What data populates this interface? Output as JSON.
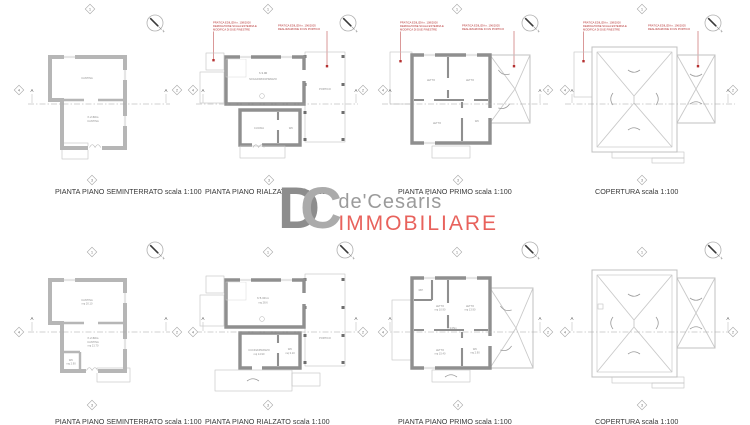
{
  "colors": {
    "annotation_red": "#b53030",
    "logo_red": "#e8625c",
    "logo_gray": "#9b9b9b",
    "wall_light": "#b6b6b6",
    "wall_dark": "#8f8f8f"
  },
  "logo": {
    "d": "D",
    "c": "C",
    "name": "de'Cesaris",
    "tag": "IMMOBILIARE"
  },
  "markers": {
    "n1": "1",
    "n2": "2",
    "n3": "3",
    "n4": "4",
    "a": "A"
  },
  "ann": {
    "a1": "PRATICA EDILIZIA n. 108/2000",
    "a2": "DEMOLIZIONE SCALA ESTERNA E",
    "a3": "MODIFICA DI DUE FINESTRE",
    "b1": "PRATICA EDILIZIA n. 196/2005",
    "b2": "REALIZZAZIONE DI UN PORTICO"
  },
  "row1": {
    "p1": {
      "title": "PIANTA PIANO SEMINTERRATO scala 1:100",
      "room_top": "CANTINA",
      "h": "h 2.60m",
      "room_bottom": "CANTINA"
    },
    "p2": {
      "title": "PIANTA PIANO RIALZATO scala 1:100",
      "h": "h 3.00",
      "living": "SOGGIORNO/PRANZO",
      "kitchen": "CUCINA",
      "wc": "WC",
      "portico": "PORTICO"
    },
    "p3": {
      "title": "PIANTA PIANO PRIMO scala 1:100",
      "r1": "LETTO",
      "r2": "LETTO",
      "r3": "LETTO",
      "wc": "WC"
    },
    "p4": {
      "title": "COPERTURA scala 1:100"
    }
  },
  "row2": {
    "p1": {
      "title": "PIANTA PIANO SEMINTERRATO scala 1:100",
      "room_top": "CANTINA",
      "mq_top": "mq 20.10",
      "h": "h 2.60m",
      "room_bottom": "CANTINA",
      "mq_bottom": "mq 21.70",
      "wc": "WC",
      "wc_mq": "mq 2.90"
    },
    "p2": {
      "title": "PIANTA PIANO RIALZATO scala 1:100",
      "h": "h 5.30 m",
      "mq": "mq 28.6",
      "kitchen": "CUCINA/PRANZO",
      "kitchen_mq": "mq 14.90",
      "wc": "WC",
      "wc_mq": "mq 3.10",
      "portico": "PORTICO"
    },
    "p3": {
      "title": "PIANTA PIANO PRIMO scala 1:100",
      "rip": "RIP.",
      "r1": "LETTO",
      "r1_mq": "mq 10.90",
      "r2": "LETTO",
      "r2_mq": "mq 13.90",
      "r3": "LETTO",
      "r3_mq": "mq 15.40",
      "wc": "WC",
      "wc_mq": "mq 2.90",
      "h": "h 3.05m"
    },
    "p4": {
      "title": "COPERTURA scala 1:100"
    }
  }
}
